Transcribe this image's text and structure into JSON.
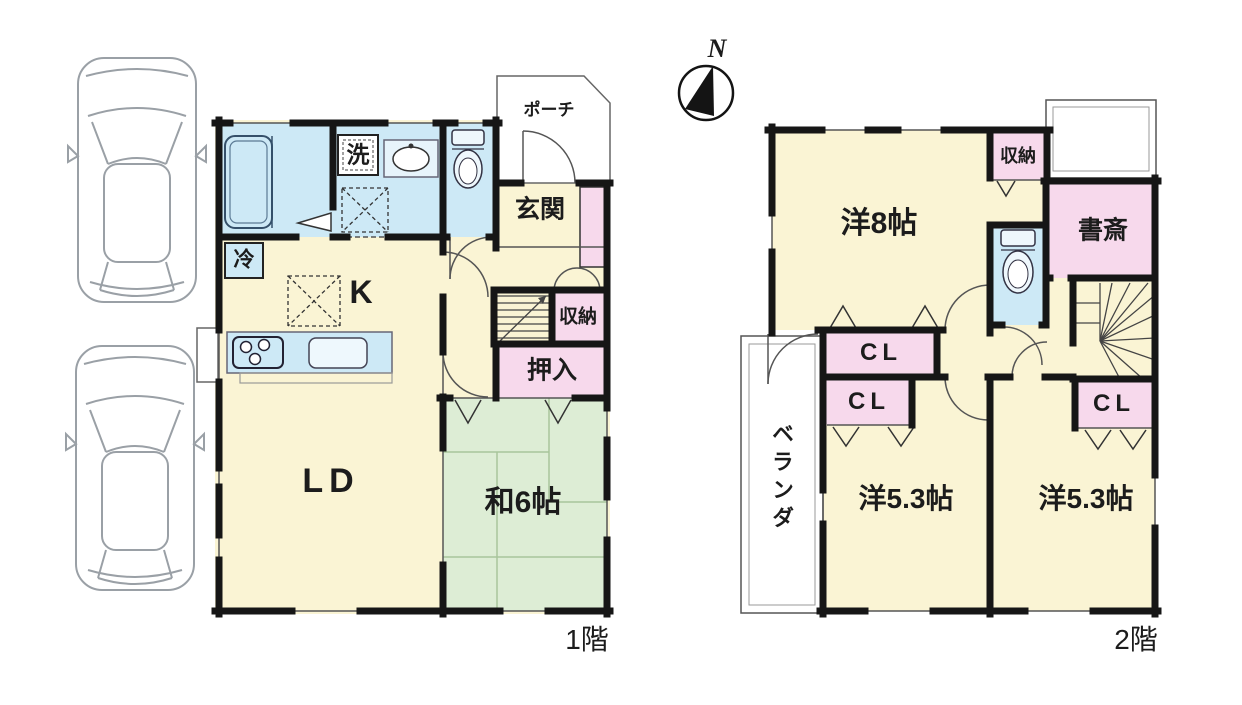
{
  "compass": {
    "north_label": "N"
  },
  "floor1": {
    "floor_label": "1階",
    "rooms": {
      "porch": "ポーチ",
      "entrance": "玄関",
      "laundry": "洗",
      "fridge": "冷",
      "kitchen": "K",
      "living_dining": "LD",
      "storage": "収納",
      "oshiire": "押入",
      "japanese_room": "和6帖"
    }
  },
  "floor2": {
    "floor_label": "2階",
    "rooms": {
      "western_8": "洋8帖",
      "storage": "収納",
      "study": "書斎",
      "closet_top": "CL",
      "closet_left": "CL",
      "closet_right": "CL",
      "western_53_left": "洋5.3帖",
      "western_53_right": "洋5.3帖",
      "veranda": "ベランダ"
    }
  },
  "colors": {
    "room_yellow": "#faf4d4",
    "water_blue": "#cde9f6",
    "closet_pink": "#f7d9ec",
    "tatami_green": "#ddedd5",
    "wall_black": "#161616",
    "outline_gray": "#9aa0a6"
  }
}
